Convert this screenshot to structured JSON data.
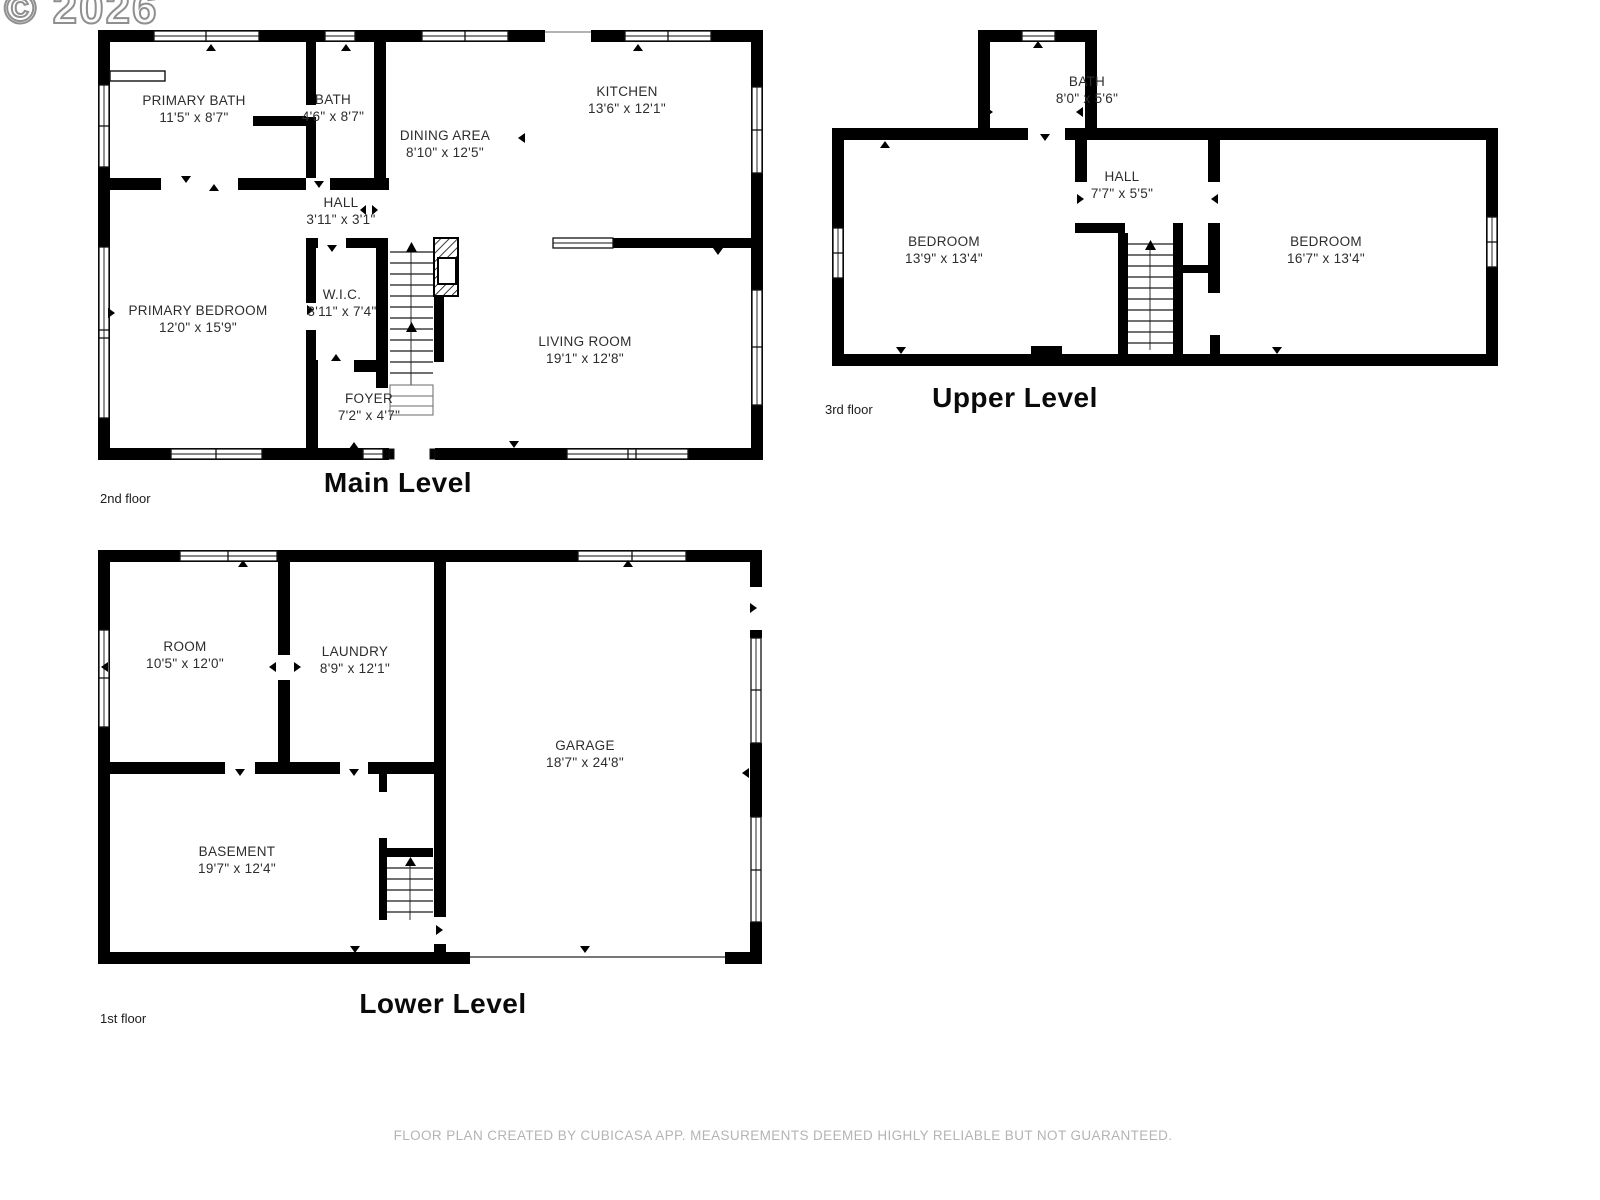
{
  "watermark": "© 2026",
  "footer": {
    "disclaimer": "FLOOR PLAN CREATED BY CUBICASA APP. MEASUREMENTS DEEMED HIGHLY RELIABLE BUT NOT GUARANTEED."
  },
  "colors": {
    "wall": "#000000",
    "room_text": "#2d2d2d",
    "muted_text": "#b4b4b4"
  },
  "levels": [
    {
      "title": "Main Level",
      "floor": "2nd floor",
      "rooms": [
        {
          "name": "PRIMARY BATH",
          "dims": "11'5\" x 8'7\""
        },
        {
          "name": "BATH",
          "dims": "4'6\" x 8'7\""
        },
        {
          "name": "KITCHEN",
          "dims": "13'6\" x 12'1\""
        },
        {
          "name": "DINING AREA",
          "dims": "8'10\" x 12'5\""
        },
        {
          "name": "HALL",
          "dims": "3'11\" x 3'1\""
        },
        {
          "name": "PRIMARY BEDROOM",
          "dims": "12'0\" x 15'9\""
        },
        {
          "name": "W.I.C.",
          "dims": "3'11\" x 7'4\""
        },
        {
          "name": "LIVING ROOM",
          "dims": "19'1\" x 12'8\""
        },
        {
          "name": "FOYER",
          "dims": "7'2\" x 4'7\""
        }
      ]
    },
    {
      "title": "Upper Level",
      "floor": "3rd floor",
      "rooms": [
        {
          "name": "BATH",
          "dims": "8'0\" x 5'6\""
        },
        {
          "name": "HALL",
          "dims": "7'7\" x 5'5\""
        },
        {
          "name": "BEDROOM",
          "dims": "13'9\" x 13'4\""
        },
        {
          "name": "BEDROOM",
          "dims": "16'7\" x 13'4\""
        }
      ]
    },
    {
      "title": "Lower Level",
      "floor": "1st floor",
      "rooms": [
        {
          "name": "ROOM",
          "dims": "10'5\" x 12'0\""
        },
        {
          "name": "LAUNDRY",
          "dims": "8'9\" x 12'1\""
        },
        {
          "name": "GARAGE",
          "dims": "18'7\" x 24'8\""
        },
        {
          "name": "BASEMENT",
          "dims": "19'7\" x 12'4\""
        }
      ]
    }
  ]
}
